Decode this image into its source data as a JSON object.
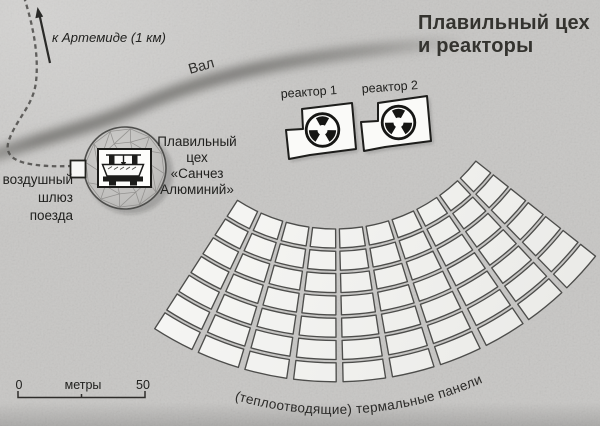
{
  "title": {
    "line1": "Плавильный цех",
    "line2": "и реакторы"
  },
  "map": {
    "arrow_label": "к Артемиде (1 км)",
    "rampart_label": "Вал",
    "reactor1_label": "реактор 1",
    "reactor2_label": "реактор 2",
    "smelter_label": [
      "Плавильный",
      "цех",
      "«Санчез",
      "Алюминий»"
    ],
    "airlock_label": [
      "воздушный",
      "шлюз",
      "поезда"
    ],
    "panels_caption": "(теплоотводящие) термальные панели",
    "thermal_panels": {
      "rows": 7,
      "columns": 10
    }
  },
  "scale_bar": {
    "start": "0",
    "unit": "метры",
    "end": "50"
  },
  "colors": {
    "background": "#c7c6c4",
    "panel_fill_light": "#f6f6f4",
    "panel_fill_dark": "#e6e6e3",
    "panel_outline": "#4d4d4b",
    "ink": "#21211f",
    "band": "#6d6c69",
    "building_fill": "#fafaf8"
  }
}
